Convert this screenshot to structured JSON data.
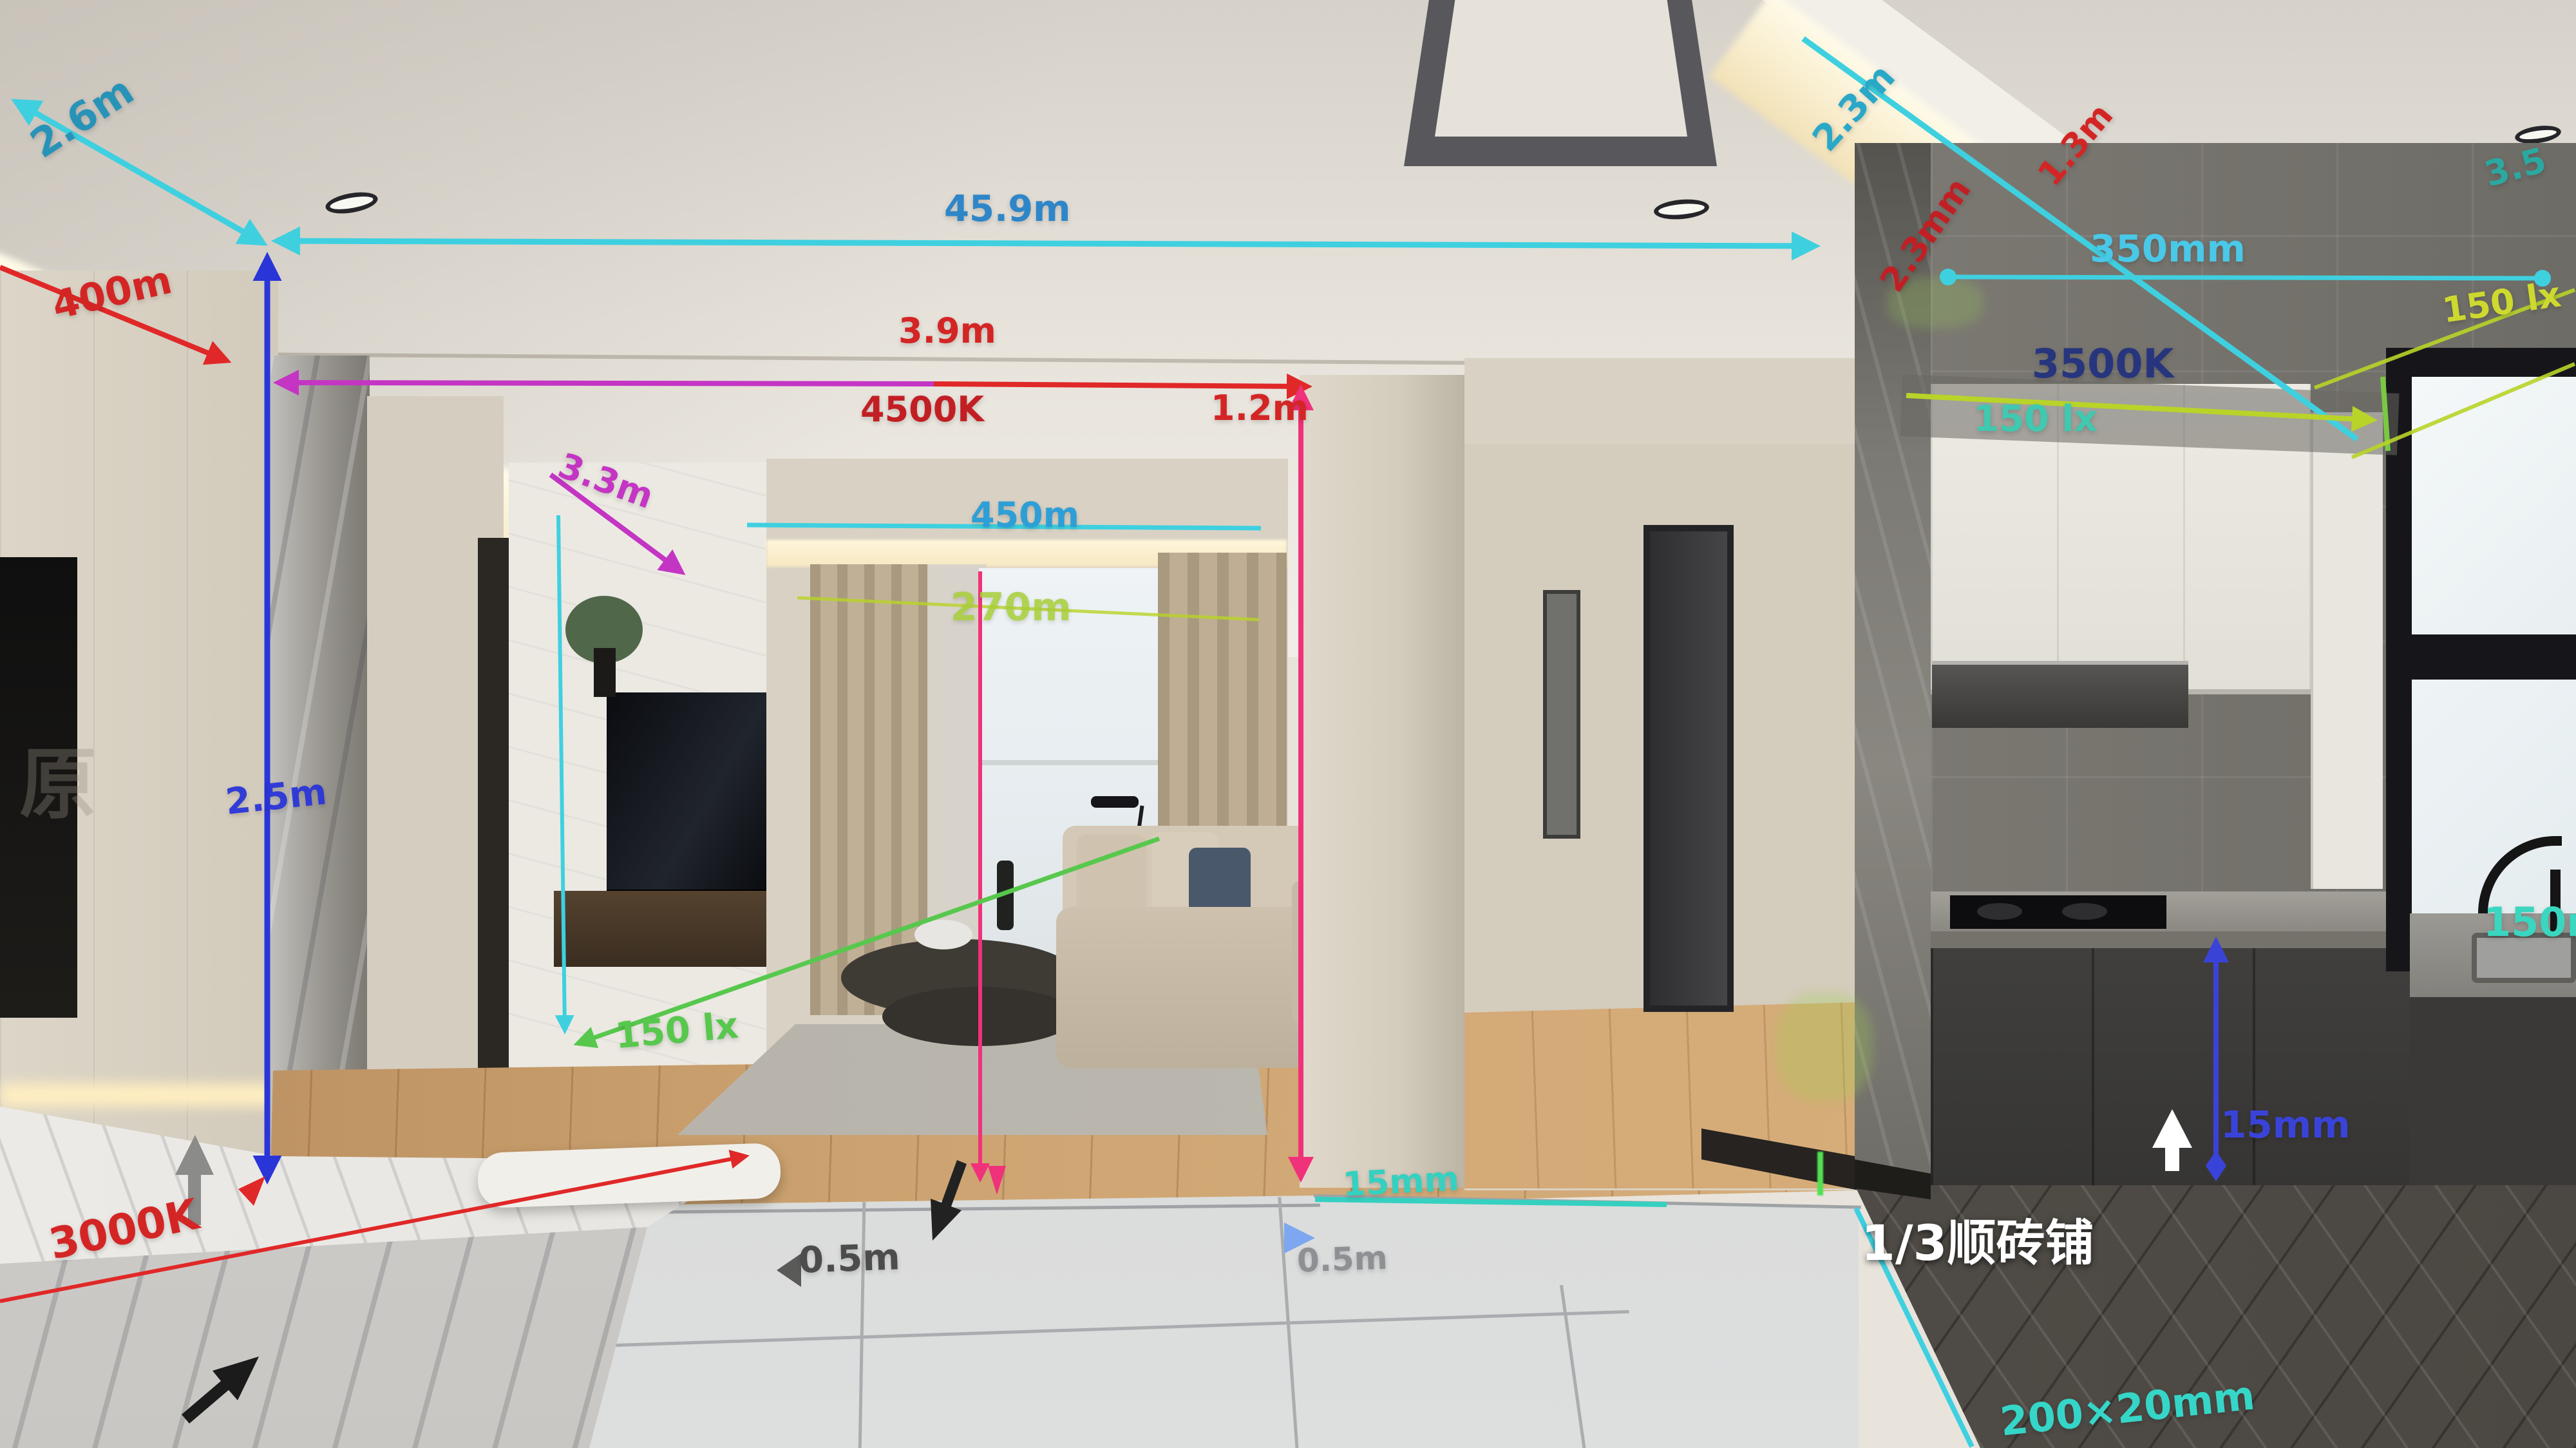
{
  "annotations": {
    "a26m": {
      "text": "2.6m",
      "color": "#2893b8"
    },
    "a400": {
      "text": "400m",
      "color": "#d42525"
    },
    "a459": {
      "text": "45.9m",
      "color": "#2e86c8"
    },
    "a39": {
      "text": "3.9m",
      "color": "#d42525"
    },
    "a4500": {
      "text": "4500K",
      "color": "#c21f24"
    },
    "a12": {
      "text": "1.2m",
      "color": "#d42525"
    },
    "a33": {
      "text": "3.3m",
      "color": "#c435c4"
    },
    "a450": {
      "text": "450m",
      "color": "#2e9fd6"
    },
    "a270": {
      "text": "270m",
      "color": "#a6ce39"
    },
    "a25": {
      "text": "2.5m",
      "color": "#2a35d8"
    },
    "a150g": {
      "text": "150 lx",
      "color": "#57c84d"
    },
    "a3000": {
      "text": "3000K",
      "color": "#d42525"
    },
    "a05a": {
      "text": "0.5m",
      "color": "#4c4c4c"
    },
    "a05b": {
      "text": "0.5m",
      "color": "#8f9094"
    },
    "a15t": {
      "text": "15mm",
      "color": "#35d0c0"
    },
    "a23c": {
      "text": "2.3m",
      "color": "#2aa8c8"
    },
    "a13r": {
      "text": "1.3m",
      "color": "#d42525"
    },
    "a23mm": {
      "text": "2.3mm",
      "color": "#c21f24"
    },
    "a350": {
      "text": "350mm",
      "color": "#49c8e8"
    },
    "a35": {
      "text": "3.5",
      "color": "#2ba8a0"
    },
    "a150y": {
      "text": "150 lx",
      "color": "#cdd92e"
    },
    "a3500": {
      "text": "3500K",
      "color": "#27357e"
    },
    "a150t": {
      "text": "150 lx",
      "color": "#3ec9b0"
    },
    "a15b": {
      "text": "15mm",
      "color": "#3a43d8"
    },
    "anote": {
      "text": "1/3顺砖铺",
      "color": "#ffffff"
    },
    "a200": {
      "text": "200×20mm",
      "color": "#35d6c8"
    },
    "a150m": {
      "text": "150mm",
      "color": "#3ad6c0"
    },
    "watermark": {
      "text": "原",
      "color": "#8a857d"
    }
  }
}
